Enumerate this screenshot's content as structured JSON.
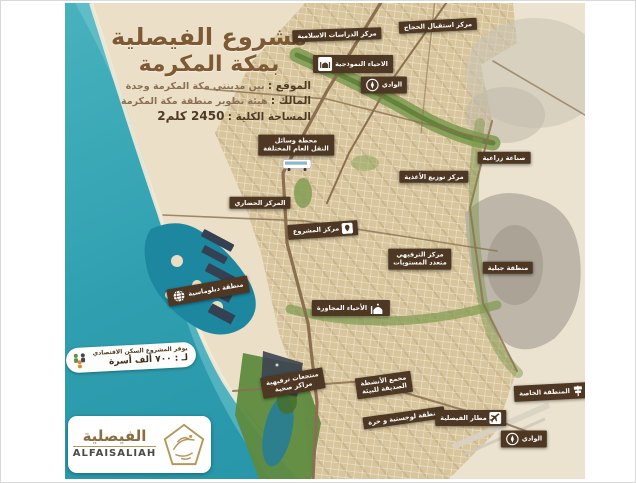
{
  "title": {
    "line1": "مشروع الفيصلية",
    "line2": "بمكة المكرمة"
  },
  "info_lines": [
    {
      "label": "الموقع :",
      "value": "بين مدينتي مكة المكرمة وجدة"
    },
    {
      "label": "المالك :",
      "value": "هيئة تطوير منطقة مكة المكرمة"
    },
    {
      "label": "المساحة الكلية :",
      "value": "2450 كلم2"
    }
  ],
  "housing_badge": {
    "line1": "يوفر المشروع السكن الاقتصادي",
    "line2": "لـ : ٧٠٠ ألف أسرة"
  },
  "logo": {
    "arabic": "الفيصلية",
    "latin": "ALFAISALIAH"
  },
  "colors": {
    "sea": "#2f9fb0",
    "sand": "#ecdfc8",
    "urban": "#d8c59b",
    "desert": "#ebe2cf",
    "green": "#7d9a4f",
    "tag_background": "#4e3823",
    "title_brown": "#7d5a33",
    "gold": "#b5975a"
  },
  "map_labels": [
    {
      "name": "hajj-reception-center",
      "text": "مركز استقبال الحجاج",
      "x": 373,
      "y": 23,
      "rot": -3
    },
    {
      "name": "islamic-studies-center",
      "text": "مركز الدراسات الاسلامية",
      "x": 272,
      "y": 32,
      "rot": -2
    },
    {
      "name": "model-districts",
      "text": "الاحياء النموذجية",
      "x": 288,
      "y": 61,
      "rot": 0,
      "icon": "mosque-badge",
      "icon_side": "left"
    },
    {
      "name": "wadi-north",
      "text": "الوادي",
      "x": 319,
      "y": 82,
      "rot": 0,
      "icon": "compass",
      "icon_side": "left"
    },
    {
      "name": "public-transport-station",
      "lines": [
        "محطة وسائل",
        "النقل العام المختلفة"
      ],
      "x": 231,
      "y": 142,
      "rot": 0
    },
    {
      "name": "transport-bus",
      "icon": "bus",
      "icon_only": true,
      "x": 232,
      "y": 162,
      "rot": 0
    },
    {
      "name": "agricultural-industry",
      "text": "صناعة زراعية",
      "x": 439,
      "y": 155,
      "rot": 0
    },
    {
      "name": "food-distribution-center",
      "text": "مركز توزيع الأغذية",
      "x": 369,
      "y": 174,
      "rot": 0
    },
    {
      "name": "civic-center",
      "text": "المركز الحضاري",
      "x": 195,
      "y": 200,
      "rot": 0
    },
    {
      "name": "project-center",
      "text": "مركز المشروع",
      "x": 258,
      "y": 227,
      "rot": -4,
      "icon": "pin",
      "icon_side": "right"
    },
    {
      "name": "multilevel-entertainment-center",
      "lines": [
        "مركز الترفيهي",
        "متعدد المستويات"
      ],
      "x": 355,
      "y": 256,
      "rot": 0
    },
    {
      "name": "mountain-area",
      "text": "منطقة جبلية",
      "x": 443,
      "y": 265,
      "rot": 0
    },
    {
      "name": "diplomatic-area",
      "text": "منطقة دبلوماسية",
      "x": 143,
      "y": 288,
      "rot": -10,
      "icon": "globe",
      "icon_side": "left"
    },
    {
      "name": "adjacent-districts",
      "text": "الأحياء المجاورة",
      "x": 286,
      "y": 305,
      "rot": 0,
      "icon": "mosque",
      "icon_side": "right"
    },
    {
      "name": "resorts-health-centers",
      "lines": [
        "منتجعات ترفيهية",
        "مراكز صحية"
      ],
      "x": 228,
      "y": 380,
      "rot": -10
    },
    {
      "name": "eco-friendly-complex",
      "lines": [
        "مجمع الأنشطة",
        "الصديقة للبيئة"
      ],
      "x": 319,
      "y": 382,
      "rot": -8
    },
    {
      "name": "logistics-free-zone",
      "text": "منطقة لوجستية و حرة",
      "x": 339,
      "y": 415,
      "rot": -8
    },
    {
      "name": "faisaliah-airport",
      "text": "مطار الفيصلية",
      "x": 406,
      "y": 415,
      "rot": 0,
      "icon": "plane",
      "icon_side": "right"
    },
    {
      "name": "special-zone",
      "text": "المنطقة الخاصة",
      "x": 486,
      "y": 389,
      "rot": -3,
      "icon": "signpost",
      "icon_side": "right"
    },
    {
      "name": "wadi-south",
      "text": "الوادي",
      "x": 459,
      "y": 436,
      "rot": 0,
      "icon": "compass",
      "icon_side": "left"
    }
  ]
}
